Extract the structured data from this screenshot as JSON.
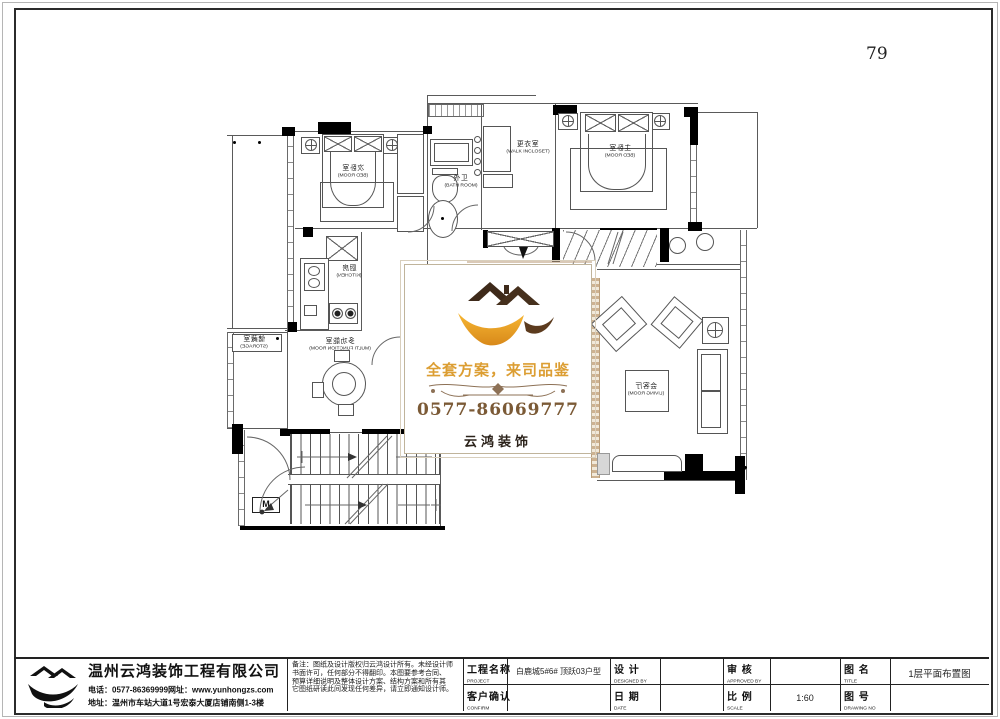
{
  "page": {
    "number": "79"
  },
  "watermark": {
    "slogan": "全套方案，来司品鉴",
    "phone": "0577-86069777",
    "brand": "云鸿装饰",
    "accent_color": "#dc9e33",
    "brown_color": "#7b5a36"
  },
  "rooms": {
    "bedL": {
      "zh": "次卧室",
      "en": "(BED ROOM)"
    },
    "bedM": {
      "zh": "主卧室",
      "en": "(BED ROOM)"
    },
    "wic": {
      "zh": "更衣室",
      "en": "(WALK INCLOSET)"
    },
    "bath": {
      "zh": "外卫",
      "en": "(BATH ROOM)"
    },
    "kitchen": {
      "zh": "厨房",
      "en": "(KITCHEN)"
    },
    "multi": {
      "zh": "多功能室",
      "en": "(MULTI FUNCTION ROOM)"
    },
    "storage": {
      "zh": "储藏室",
      "en": "(STORAGE)"
    },
    "living": {
      "zh": "会客厅",
      "en": "(LIVING ROOM)"
    }
  },
  "stairs": {
    "m": "M"
  },
  "tb": {
    "company": {
      "name": "温州云鸿装饰工程有限公司",
      "phone": "电话：0577-86369999网址：www.yunhongzs.com",
      "address": "地址：温州市车站大道1号宏泰大厦店铺南侧1-3楼"
    },
    "notes": [
      "备注：图纸及设计版权归云鸿设计所有。未经设计师",
      "书面许可，任何部分不得翻印。本图要参考合同、",
      "预算详细说明及整体设计方案、结构方案和所有其",
      "它图纸研读此间发现任何差异，请立即通知设计师。"
    ],
    "fields": {
      "project": {
        "label": "工程名称",
        "sub": "PROJECT",
        "value": "白鹿城5#6#  顶跃03户型"
      },
      "design": {
        "label": "设 计",
        "sub": "DESIGNED BY",
        "value": ""
      },
      "approved": {
        "label": "审 核",
        "sub": "APPROVED BY",
        "value": ""
      },
      "title": {
        "label": "图 名",
        "sub": "TITLE",
        "value": "1层平面布置图"
      },
      "confirm": {
        "label": "客户确认",
        "sub": "CONFIRM",
        "value": ""
      },
      "date": {
        "label": "日 期",
        "sub": "DATE",
        "value": ""
      },
      "scale": {
        "label": "比 例",
        "sub": "SCALE",
        "value": "1:60"
      },
      "drawing": {
        "label": "图 号",
        "sub": "DRAWING NO",
        "value": ""
      }
    }
  }
}
